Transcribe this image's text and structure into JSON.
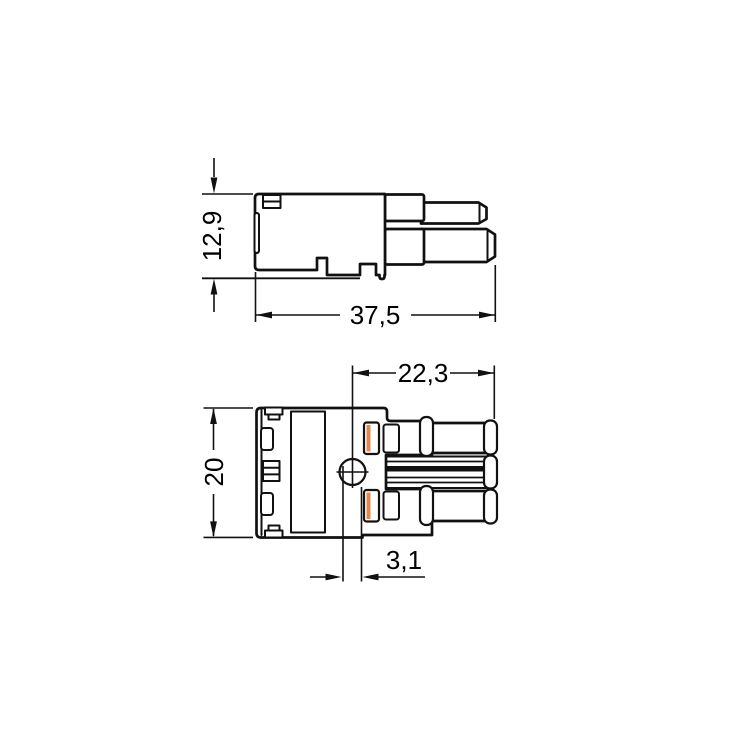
{
  "drawing": {
    "description": "Technical dimension drawing of a 2-pole connector, two orthographic views",
    "colors": {
      "background": "#ffffff",
      "line": "#111111",
      "lever_fill": "#f4a76b",
      "lever_shade": "#e18a4d"
    },
    "side_view": {
      "height_label": "12,9",
      "length_label": "37,5"
    },
    "front_view": {
      "height_label": "20",
      "width_label": "22,3",
      "hole_label": "3,1"
    }
  }
}
